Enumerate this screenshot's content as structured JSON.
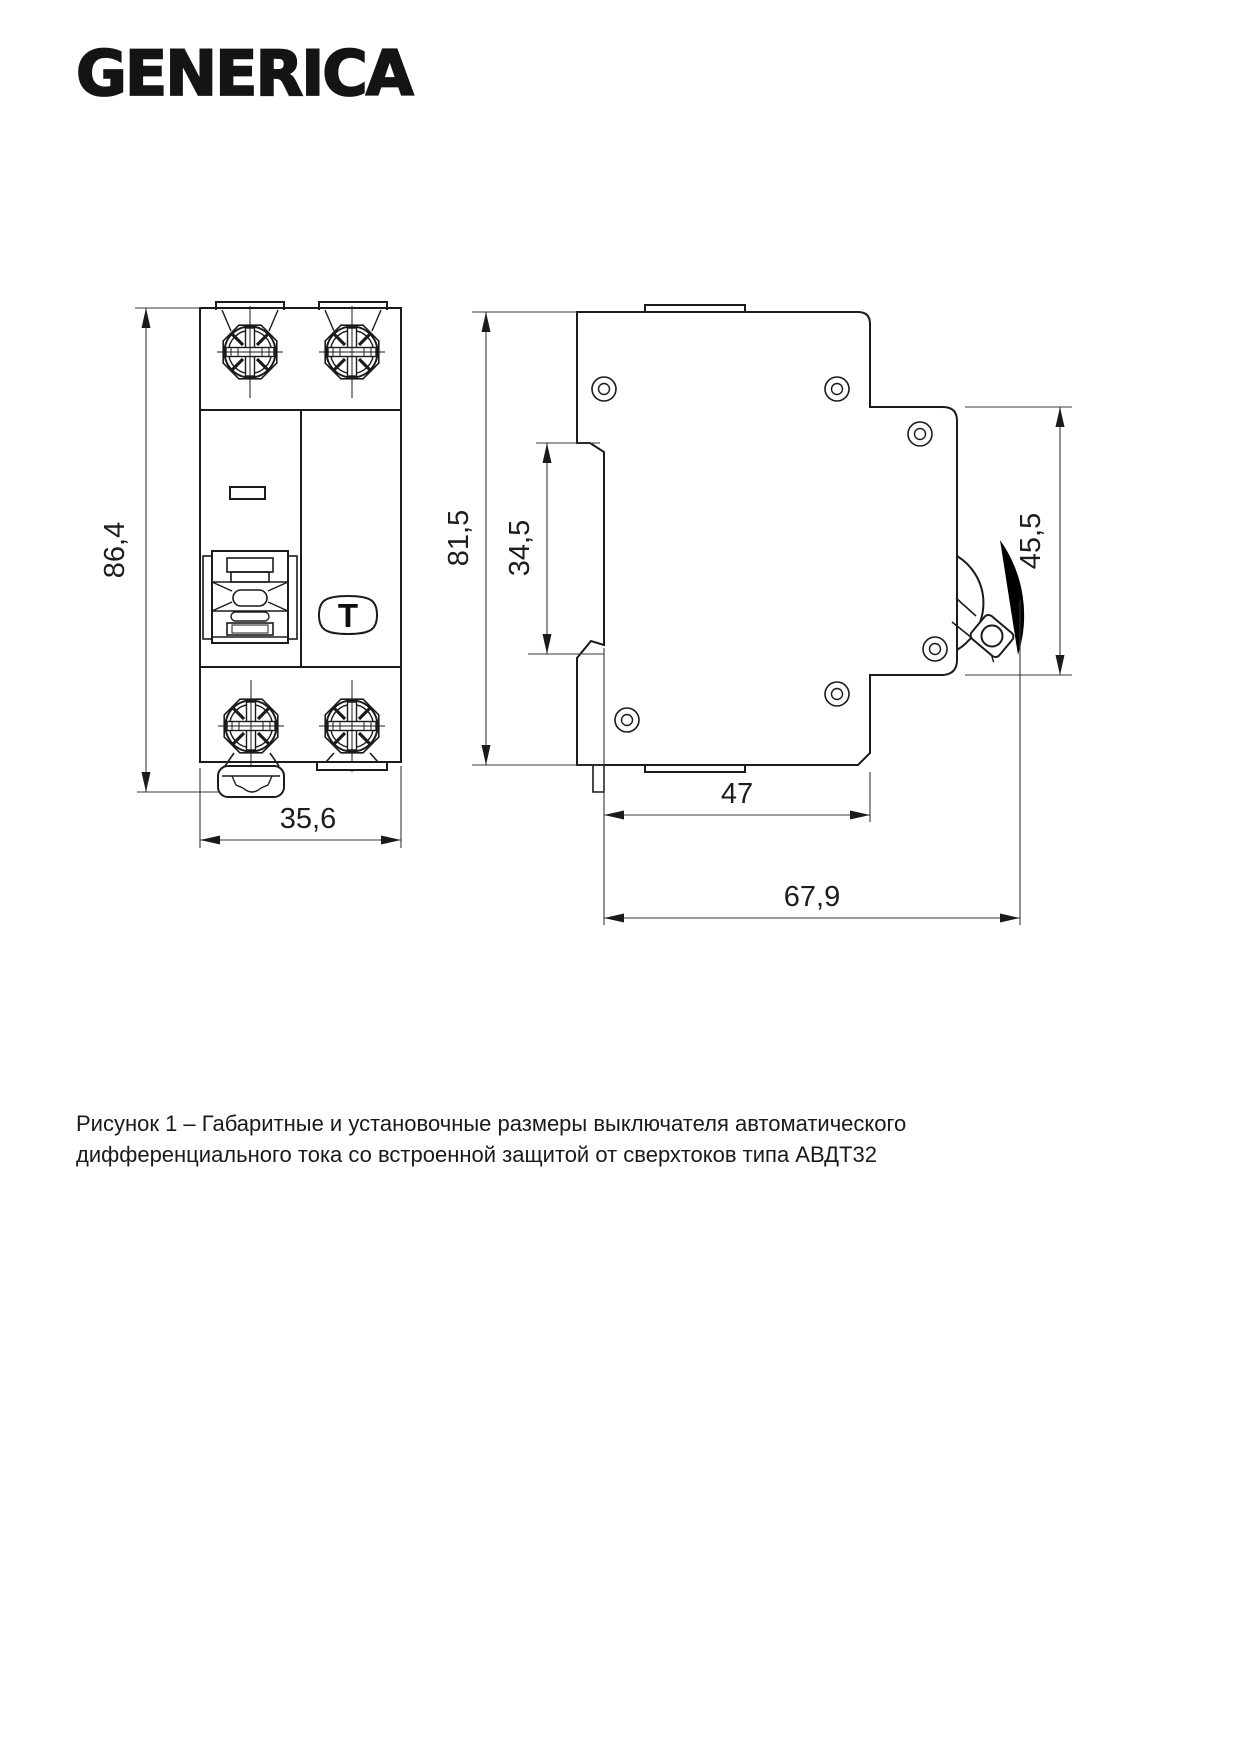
{
  "logo": {
    "text": "GENERICA"
  },
  "dimensions": {
    "front_height": "86,4",
    "front_width": "35,6",
    "side_height": "81,5",
    "din_slot": "34,5",
    "panel_height": "45,5",
    "body_depth": "47",
    "total_depth": "67,9"
  },
  "front_view": {
    "test_button_label": "T"
  },
  "caption": {
    "line1": "Рисунок 1 – Габаритные и установочные размеры выключателя автоматического",
    "line2": "дифференциального тока со встроенной защитой от сверхтоков типа АВДТ32"
  },
  "colors": {
    "line": "#1b1b1b",
    "dim_line": "#383838",
    "text": "#1a1a1a",
    "background": "#ffffff"
  }
}
